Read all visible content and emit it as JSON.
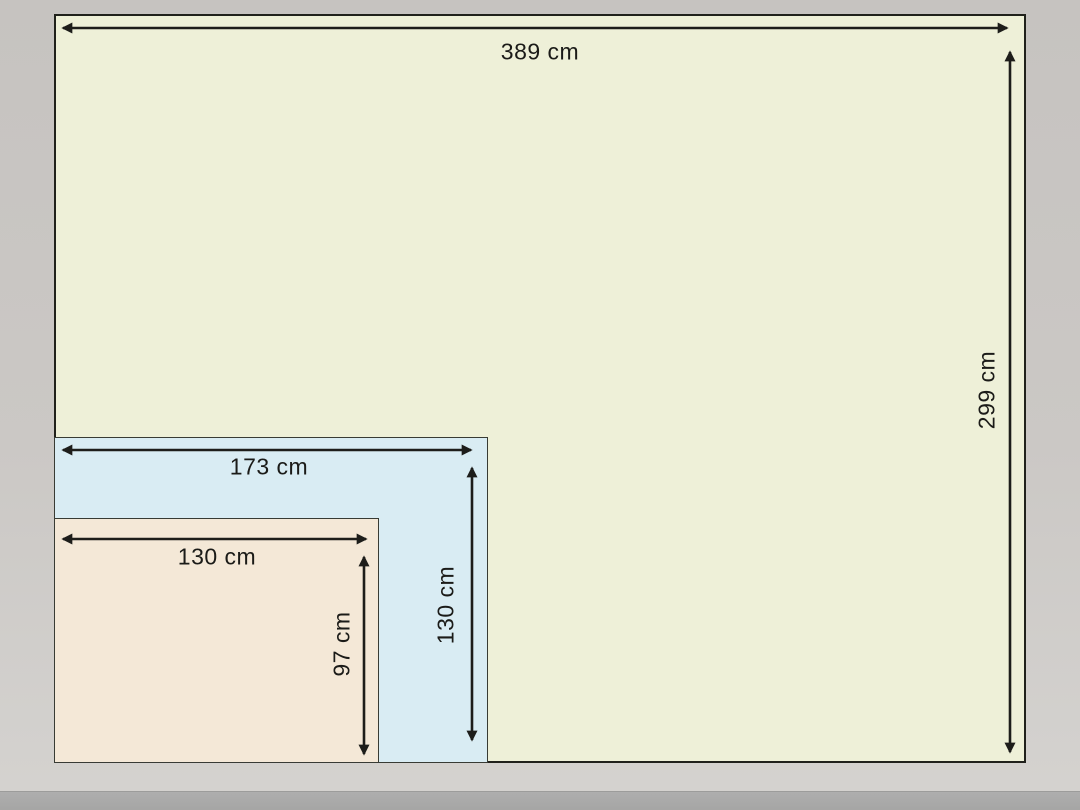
{
  "unit": "cm",
  "rectangles": [
    {
      "id": "outer",
      "width_label": "389 cm",
      "height_label": "299 cm",
      "fill": "#eef0d8"
    },
    {
      "id": "middle",
      "width_label": "173 cm",
      "height_label": "130 cm",
      "fill": "#d9ecf3"
    },
    {
      "id": "inner",
      "width_label": "130 cm",
      "height_label": "97 cm",
      "fill": "#f4e8d7"
    }
  ],
  "colors": {
    "background": "#cbc8c5",
    "bottom_bar": "#a6a6a5",
    "line": "#1d1d1a",
    "outer_fill": "#eef0d8",
    "middle_fill": "#d9ecf3",
    "inner_fill": "#f4e8d7"
  }
}
